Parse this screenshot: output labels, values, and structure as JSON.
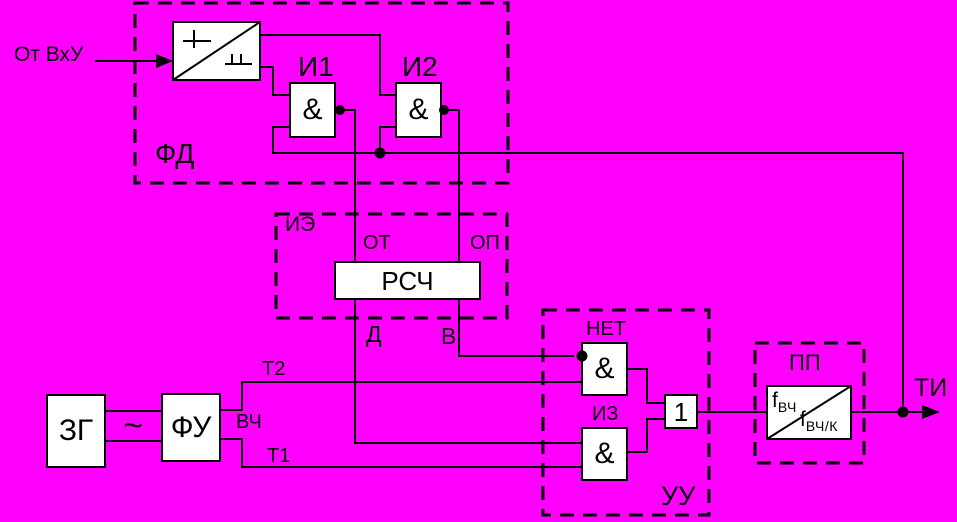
{
  "colors": {
    "background": "#ff00ff",
    "line": "#000000",
    "box_fill": "#ffffff"
  },
  "io": {
    "input_label": "От ВхУ",
    "output_label": "ТИ"
  },
  "fd_block": {
    "label": "ФД",
    "and1_name": "И1",
    "and1_symbol": "&",
    "and2_name": "И2",
    "and2_symbol": "&"
  },
  "ie_block": {
    "label": "ИЭ",
    "counter_label": "РСЧ",
    "input_left": "ОТ",
    "input_right": "ОП",
    "output_left": "Д",
    "output_right": "В"
  },
  "uu_block": {
    "label": "УУ",
    "net_name": "НЕТ",
    "net_symbol": "&",
    "iz_name": "ИЗ",
    "iz_symbol": "&",
    "or_symbol": "1"
  },
  "pp_block": {
    "label": "ПП",
    "f_in_base": "f",
    "f_in_sub": "ВЧ",
    "f_out_base": "f",
    "f_out_sub": "ВЧ/К"
  },
  "zg_block": {
    "label": "ЗГ"
  },
  "fu_block": {
    "label": "ФУ"
  },
  "signals": {
    "sine": "~",
    "vch": "ВЧ",
    "t1": "Т1",
    "t2": "Т2"
  }
}
